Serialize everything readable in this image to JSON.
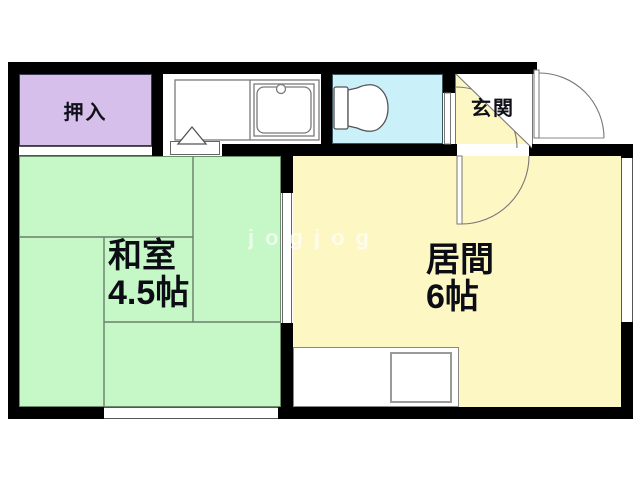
{
  "title": "apartment-floor-plan",
  "watermark": {
    "text": "jogjog"
  },
  "rooms": {
    "closet": {
      "label": "押入"
    },
    "entrance": {
      "label": "玄関"
    },
    "japanese_room": {
      "label": "和室",
      "size": "4.5帖"
    },
    "living_room": {
      "label": "居間",
      "size": "6帖"
    },
    "kitchen": {
      "label": ""
    },
    "toilet": {
      "label": ""
    }
  },
  "colors": {
    "wall": "#000000",
    "closet": "#d6bfeb",
    "japanese_room": "#c6f7c6",
    "living_room": "#fcf7c3",
    "entrance": "#fcf7c3",
    "toilet": "#caf0fa",
    "line": "#6b7d6b"
  }
}
